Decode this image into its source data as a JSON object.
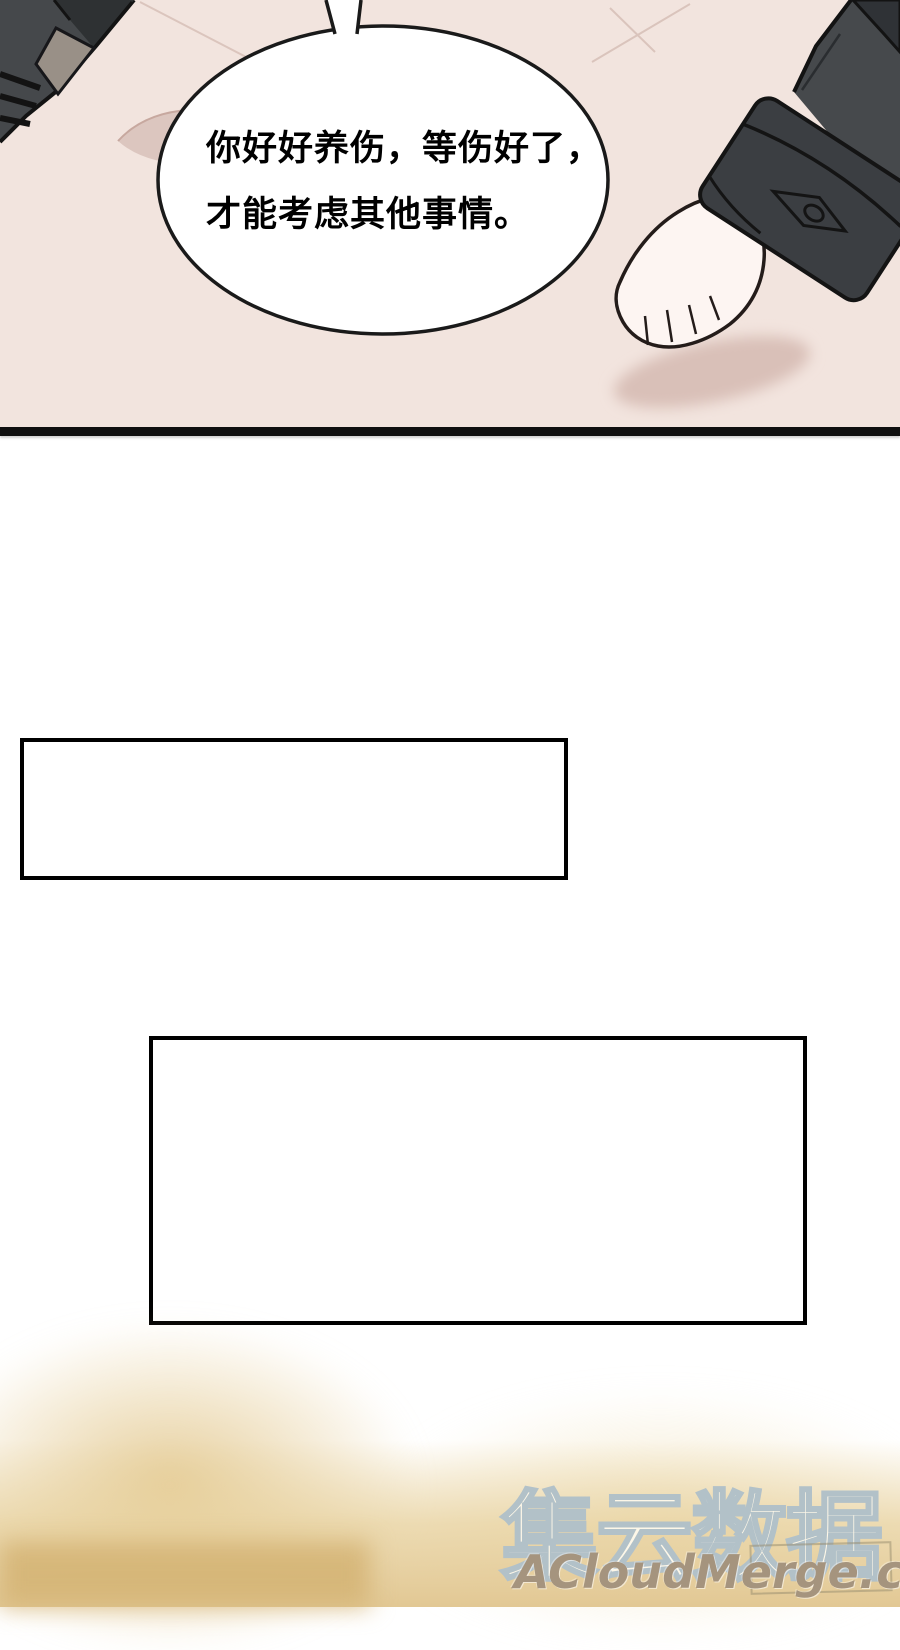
{
  "panel": {
    "speech_bubble": {
      "line1": "你好好养伤，等伤好了，",
      "line2": "才能考虑其他事情。"
    }
  },
  "watermark": {
    "brand_text": "集云数据",
    "site_text": "ACloudMerge.com"
  },
  "colors": {
    "panel_bg": "#f2e4de",
    "divider_black": "#0f0f0f",
    "box_border": "#000000",
    "sleeve_gray": "#46494c",
    "sleeve_dark": "#2e3133",
    "patch_gray": "#999087",
    "hand_skin": "#fdf5f2",
    "shadow_pink": "#d9c0b8",
    "bubble_fill": "#ffffff",
    "bubble_outline": "#1a1a1a",
    "watermark_fill": "#fdf7e8",
    "watermark_outline": "#b2c1c8",
    "site_text_color": "#a5947e",
    "bottom_tan": "#e2c894"
  }
}
